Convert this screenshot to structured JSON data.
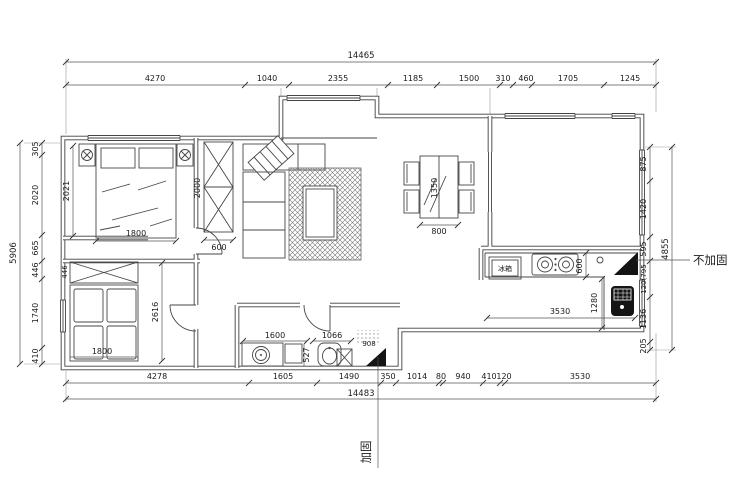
{
  "dims": {
    "top": {
      "overall": "14465",
      "segments": [
        "4270",
        "1040",
        "2355",
        "1185",
        "1500",
        "310",
        "460",
        "1705",
        "1245"
      ]
    },
    "bottom": {
      "overall": "14483",
      "segments": [
        "4278",
        "1605",
        "1490",
        "350",
        "1014",
        "80",
        "940",
        "410",
        "120",
        "3530"
      ]
    },
    "left": {
      "overall": "5906",
      "segments": [
        "305",
        "2020",
        "665",
        "446",
        "1740",
        "410"
      ]
    },
    "right": {
      "overall": "4855",
      "segments": [
        "875",
        "1420",
        "595",
        "120(795",
        "1136",
        "205"
      ]
    }
  },
  "interior": {
    "master": {
      "depth": "2021",
      "bed_width": "1800",
      "wardrobe_height": "2000",
      "wardrobe_width": "600"
    },
    "dining": {
      "table_length": "1350",
      "table_width": "800"
    },
    "kitchen": {
      "fridge_label": "冰箱",
      "counter_depth": "600",
      "counter_run": "3530",
      "side_run": "1280"
    },
    "bathroom": {
      "vanity_width": "1600",
      "vanity_depth": "527",
      "toilet_width": "1066",
      "niche_width": "908"
    },
    "bedroom2": {
      "bed_width": "1800",
      "room_depth": "2616",
      "wardrobe_depth": "446"
    }
  },
  "annotations": {
    "not_reinforced": "不加固",
    "reinforced": "加固"
  }
}
